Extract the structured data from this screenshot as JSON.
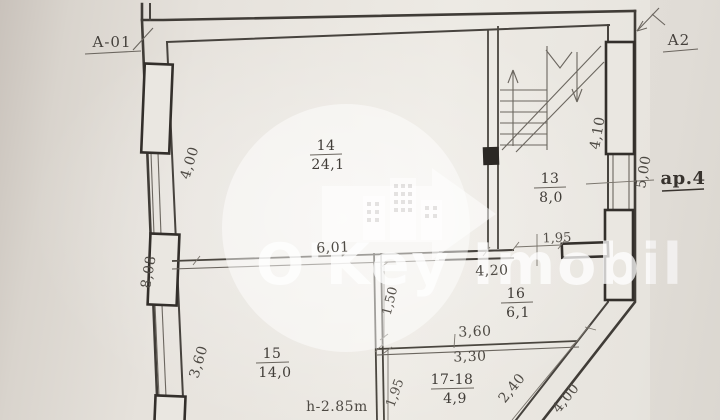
{
  "plan": {
    "section_marks": {
      "left": "A-01",
      "right": "A2"
    },
    "apartment_label": "ap.4",
    "height_note": "h-2.85m",
    "watermark_brand": "O'Key Imobil",
    "rooms": [
      {
        "number": "14",
        "area": "24,1"
      },
      {
        "number": "13",
        "area": "8,0"
      },
      {
        "number": "16",
        "area": "6,1"
      },
      {
        "number": "15",
        "area": "14,0"
      },
      {
        "number": "17-18",
        "area": "4,9"
      }
    ],
    "dimensions": {
      "left_upper": "4,00",
      "left_middle": "8,08",
      "left_lower": "3,60",
      "room14_width": "6,01",
      "door_width": "1,95",
      "room16_top_width": "4,20",
      "room16_left_height": "1,50",
      "room16_bottom_width": "3,60",
      "room1718_top_width": "3,30",
      "room1718_left_height": "1,95",
      "diagonal_inner": "2,40",
      "diagonal_outer": "4,00",
      "stair_height": "4,10",
      "right_height": "5,00"
    }
  }
}
